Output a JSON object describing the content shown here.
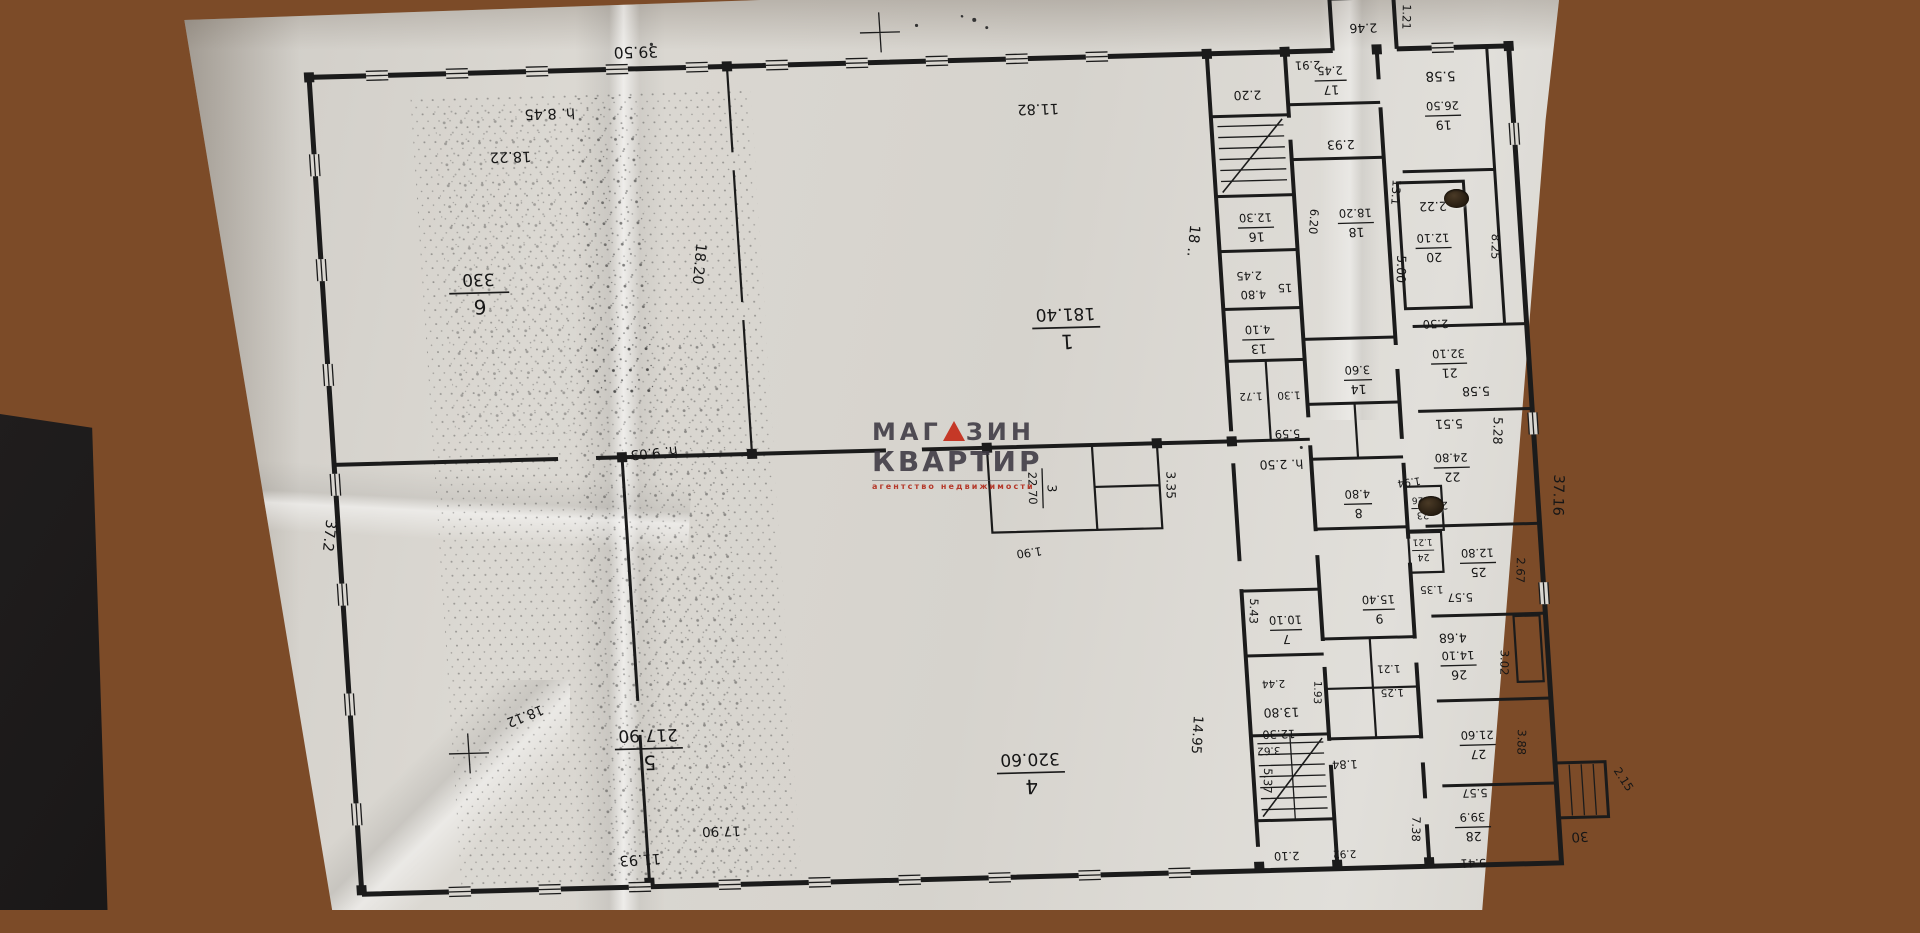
{
  "scene": {
    "description": "Photocopied architectural floor plan sheet lying on a wooden table, plan printed upside-down",
    "paper_color": "#dbd8d2",
    "wood_color": "#8a5531",
    "ink_color": "#1b1b1b"
  },
  "watermark": {
    "brand_top_left": "МАГ",
    "brand_top_right": "ЗИН",
    "triangle_icon": "red-triangle",
    "brand_bottom": "КВАРТИР",
    "tagline": "агентство недвижимости",
    "accent_color": "#c53827"
  },
  "plan": {
    "halls": {
      "r6": {
        "num": "6",
        "area": "330"
      },
      "r1": {
        "num": "1",
        "area": "181.40"
      },
      "r5": {
        "num": "5",
        "area": "217.90"
      },
      "r4": {
        "num": "4",
        "area": "320.60"
      },
      "r3": {
        "num": "3",
        "area": "22.70"
      }
    },
    "rooms": {
      "r7": {
        "num": "7",
        "area": "10.10"
      },
      "r8": {
        "num": "8",
        "area": "4.80"
      },
      "r9": {
        "num": "9",
        "area": "15.40"
      },
      "r13": {
        "num": "13",
        "area": "4.10"
      },
      "r14": {
        "num": "14",
        "area": "3.60"
      },
      "r16": {
        "num": "16",
        "area": "12.30"
      },
      "r17": {
        "num": "17",
        "area": "2.45"
      },
      "r18": {
        "num": "18",
        "area": "18.20"
      },
      "r19": {
        "num": "19",
        "area": "26.50"
      },
      "r20": {
        "num": "20",
        "area": "12.10"
      },
      "r21": {
        "num": "21",
        "area": "32.10"
      },
      "r22": {
        "num": "22",
        "area": "24.80"
      },
      "r23": {
        "num": "23",
        "area": "1.26"
      },
      "r24": {
        "num": "24",
        "area": "1.21"
      },
      "r25": {
        "num": "25",
        "area": "12.80"
      },
      "r26": {
        "num": "26",
        "area": "14.10"
      },
      "r27": {
        "num": "27",
        "area": "21.60"
      },
      "r28": {
        "num": "28",
        "area": "39.9"
      },
      "r30": "30"
    },
    "dims": {
      "top_3950": "39.50",
      "h_845": "h. 8.45",
      "w_1822": "18.22",
      "w_1182": "11.82",
      "w_1820": "18.20",
      "w_18x": "18 ..",
      "h_903": "h. 9.03",
      "w_1812": "18.12",
      "w_1193": "11.93",
      "w_1790": "17.90",
      "left_372": "37.2",
      "right_3716": "37.16",
      "corr_1495": "14.95",
      "c_220": "2.20",
      "c_245": "2.45",
      "c_480": "4.80",
      "c_15": "15",
      "c_559": "5.59",
      "c_172": "1.72",
      "c_130": "1.30",
      "h_250": "h. 2.50",
      "c_620": "6.20",
      "c_293": "2.93",
      "c_291": "2.91",
      "c_131": "13.1",
      "c_1380": "13.80",
      "c_362": "3.62",
      "c_244": "2.44",
      "c_193": "1.93",
      "c_1230": "12.30",
      "c_210": "2.10",
      "c_543": "5.43",
      "c_537": "5.37",
      "c_184": "1.84",
      "c_292": "2.92",
      "c_335": "3.35",
      "c_190": "1.90",
      "c_246": "2.46",
      "c_121": "1.21",
      "c_558a": "5.58",
      "c_222": "2.22",
      "c_250": "2.50",
      "c_500": "5.00",
      "c_825": "8.25",
      "c_558b": "5.58",
      "c_551": "5.51",
      "c_528": "5.28",
      "c_230": "2.30",
      "c_194": "1.94",
      "c_135": "1.35",
      "c_125": "1.25",
      "c_121b": "1.21",
      "c_267": "2.67",
      "c_557a": "5.57",
      "c_468": "4.68",
      "c_302": "3.02",
      "c_388": "3.88",
      "c_557b": "5.57",
      "c_738": "7.38",
      "c_541": "5.41",
      "c_215": "2.15"
    }
  }
}
